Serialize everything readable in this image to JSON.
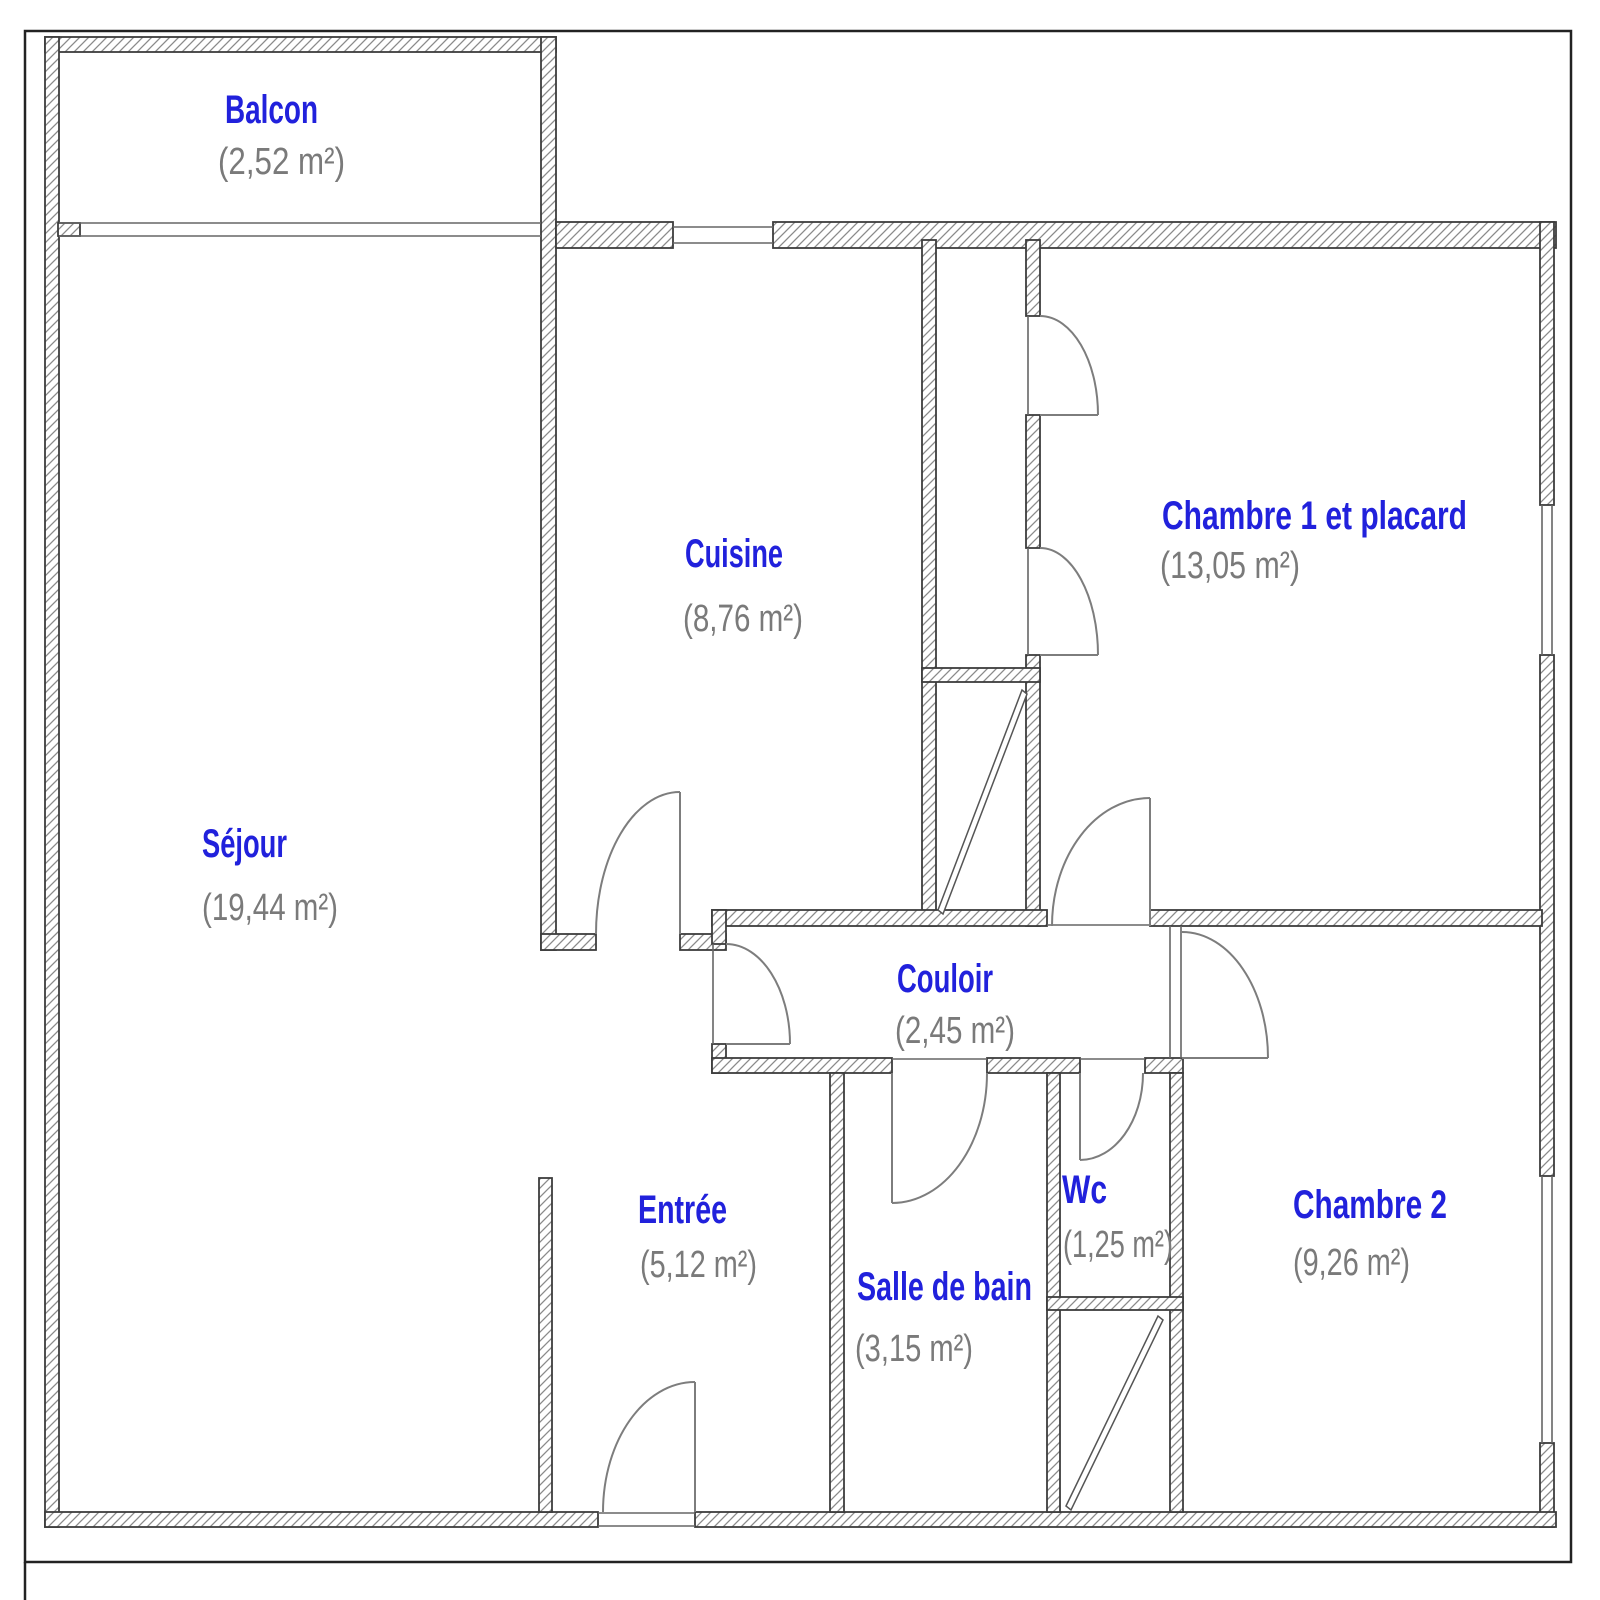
{
  "plan": {
    "type": "apartment-floor-plan",
    "colors": {
      "room_name": "#2121dc",
      "room_area": "#7a7a7a",
      "wall_outline": "#3d3d3d",
      "hatch_line": "#8a8a8a",
      "door_line": "#7d7d7d",
      "window_line": "#666666",
      "border": "#222222"
    },
    "rooms": [
      {
        "id": "balcon",
        "name": "Balcon",
        "area": "(2,52 m²)"
      },
      {
        "id": "cuisine",
        "name": "Cuisine",
        "area": "(8,76 m²)"
      },
      {
        "id": "chambre1",
        "name": "Chambre 1 et placard",
        "area": "(13,05 m²)"
      },
      {
        "id": "sejour",
        "name": "Séjour",
        "area": "(19,44 m²)"
      },
      {
        "id": "couloir",
        "name": "Couloir",
        "area": "(2,45 m²)"
      },
      {
        "id": "entree",
        "name": "Entrée",
        "area": "(5,12 m²)"
      },
      {
        "id": "salle-de-bain",
        "name": "Salle de bain",
        "area": "(3,15 m²)"
      },
      {
        "id": "wc",
        "name": "Wc",
        "area": "(1,25 m²)"
      },
      {
        "id": "chambre2",
        "name": "Chambre 2",
        "area": "(9,26 m²)"
      }
    ]
  }
}
